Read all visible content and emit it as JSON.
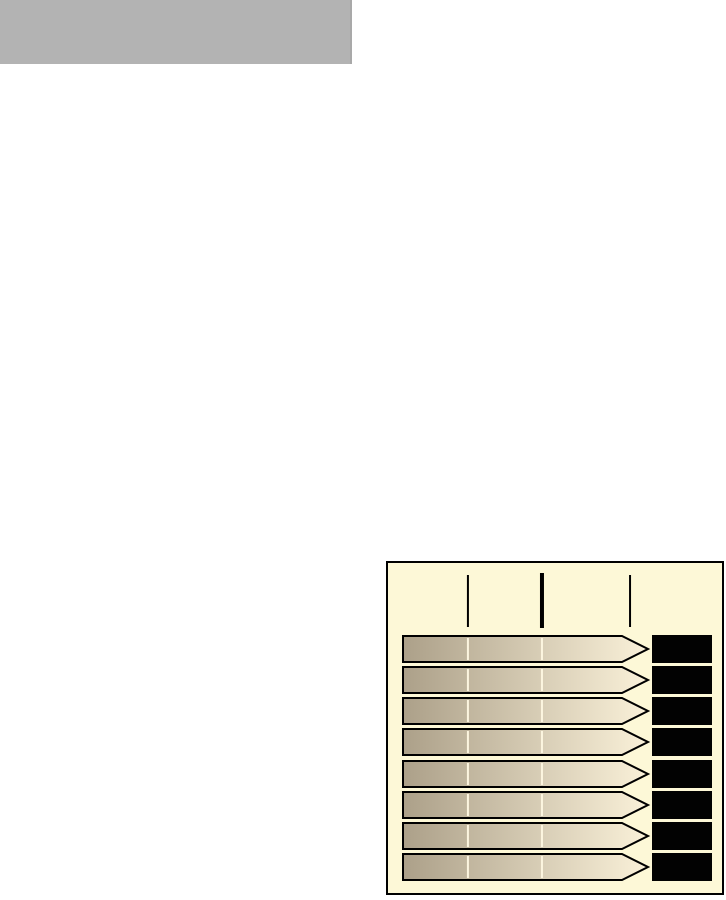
{
  "page": {
    "background": "#ffffff"
  },
  "header_block": {
    "color": "#b3b3b3",
    "right_seam_color": "#a9a9a9"
  },
  "panel": {
    "background": "#fdf8d7",
    "border_color": "#000000"
  },
  "chart_data": {
    "type": "bar",
    "title": "",
    "xlabel": "",
    "ylabel": "",
    "orientation": "horizontal-arrow-gauge",
    "categories": [
      "bar-1",
      "bar-2",
      "bar-3",
      "bar-4",
      "bar-5",
      "bar-6",
      "bar-7",
      "bar-8"
    ],
    "values": [
      1,
      1,
      1,
      1,
      1,
      1,
      1,
      1
    ],
    "xlim": [
      0,
      1
    ],
    "value_labels": [
      "",
      "",
      "",
      "",
      "",
      "",
      "",
      ""
    ],
    "value_boxes": "solid-black-obscured",
    "axis_tick_fractions": [
      0.268,
      0.569,
      0.927
    ],
    "axis_tick_emphasized_index": 1,
    "bar_inner_tick_fractions": [
      0.268,
      0.569
    ],
    "legend": "none",
    "grid": "off",
    "colors": {
      "bar_gradient_start": "#aca089",
      "bar_gradient_end": "#faf1d9",
      "bar_outline": "#000000",
      "bar_inner_tick": "#fcf5df",
      "scale_tick": "#000000",
      "value_box": "#020202"
    }
  }
}
